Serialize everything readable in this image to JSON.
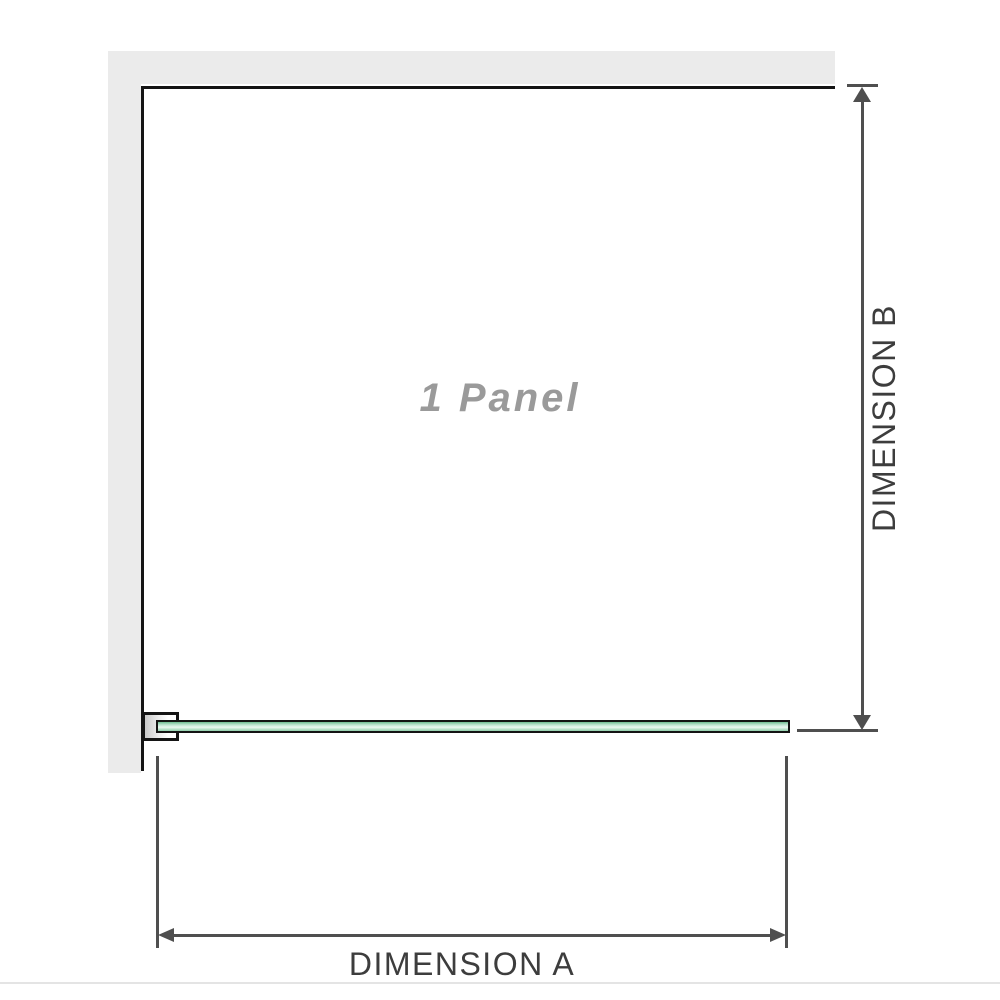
{
  "diagram": {
    "type": "shower-panel-dimension-diagram",
    "panel_label": "1 Panel",
    "dimension_a": {
      "label": "DIMENSION A",
      "orientation": "horizontal",
      "measures": "panel width"
    },
    "dimension_b": {
      "label": "DIMENSION B",
      "orientation": "vertical",
      "measures": "panel height"
    }
  },
  "colors": {
    "wall": "#ebebeb",
    "outline": "#141414",
    "dimension_line": "#4f4f4f",
    "dimension_text": "#3d3d3d",
    "panel_label_text": "#9a9a9a",
    "glass_top": "#6fbd92",
    "glass_light": "#bce3cf",
    "glass_mid": "#ecf8f1",
    "glass_bottom": "#8fceaa",
    "bracket_shade": "#c9c9c9",
    "divider": "#e4e4e4"
  }
}
